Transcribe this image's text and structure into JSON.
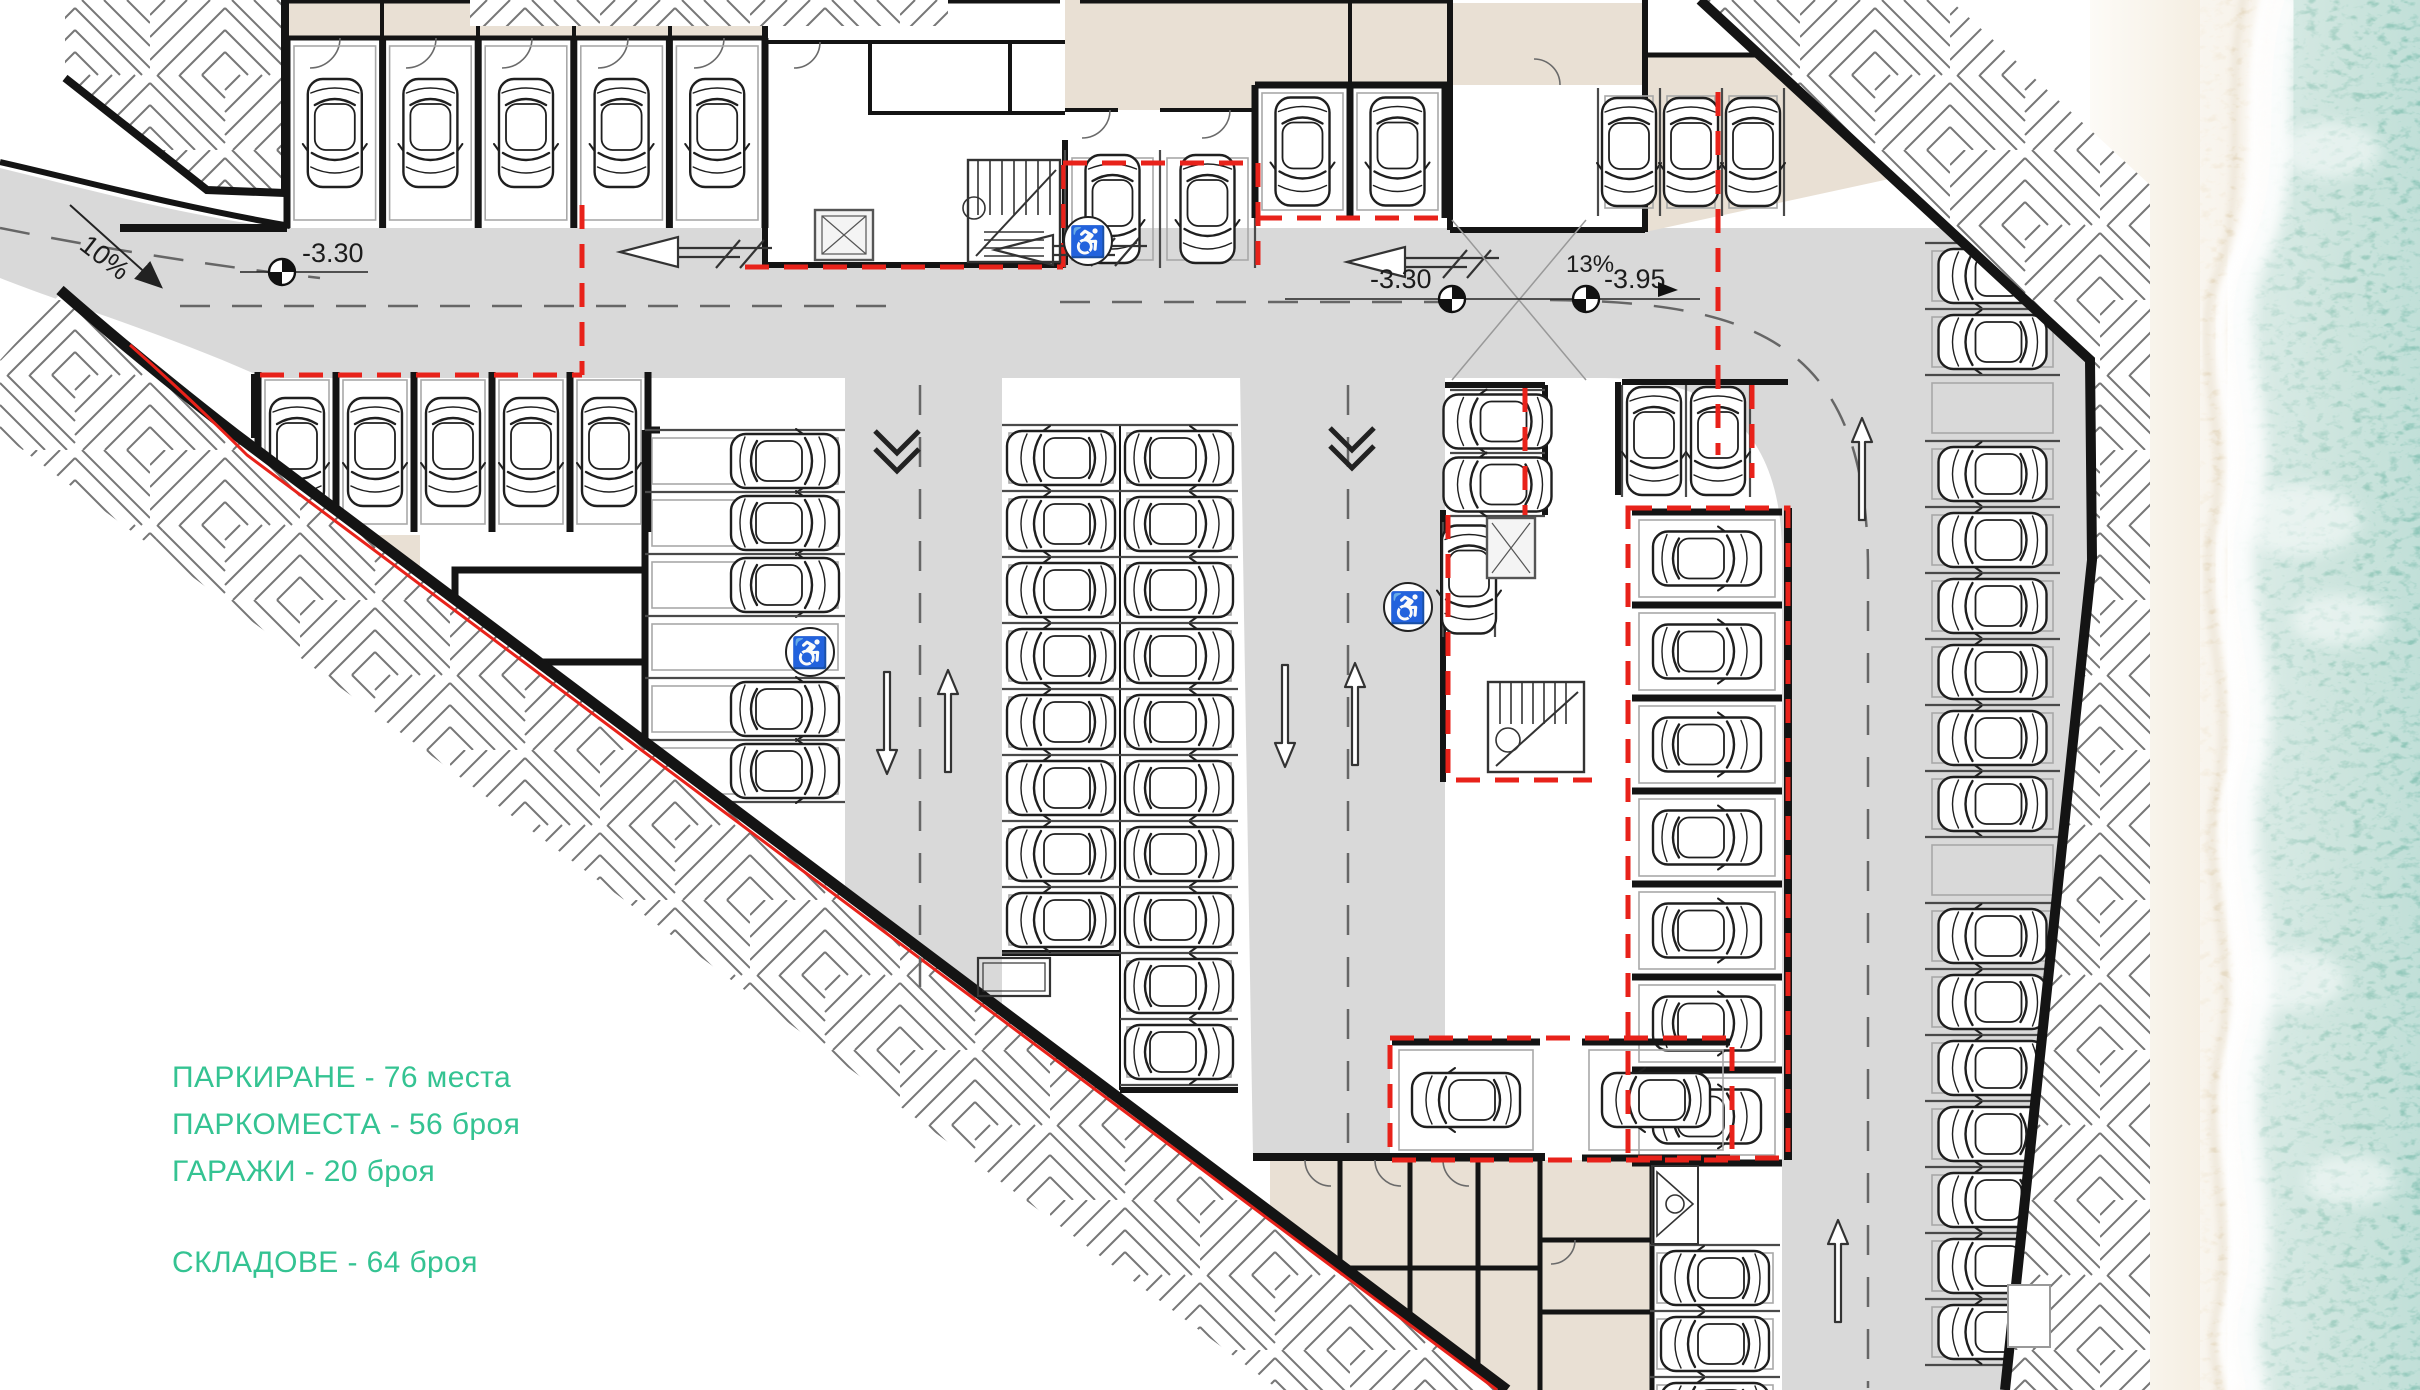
{
  "title": "Подземен паркинг - разпределение",
  "legend": {
    "color": "#34c392",
    "lines": [
      {
        "text": "ПАРКИРАНЕ - 76 места"
      },
      {
        "text": "ПАРКОМЕСТА - 56 броя"
      },
      {
        "text": "ГАРАЖИ - 20 броя"
      },
      {
        "text": "СКЛАДОВЕ - 64 броя"
      }
    ]
  },
  "annotations": {
    "ramp_left_slope": "10%",
    "level_left": "-3.30",
    "level_mid": "-3.30",
    "ramp_mid_slope": "13%",
    "level_right": "-3.95"
  },
  "colors": {
    "aisle": "#d9d9d9",
    "room_beige": "#e9e0d4",
    "wall": "#141414",
    "red_zone": "#e8221a",
    "legend_green": "#34c392",
    "water": "#8cc5b8",
    "water_light": "#c2ded6",
    "sand": "#e9ddc9",
    "sand_light": "#fdfbf7"
  },
  "symbols": {
    "accessible": "♿"
  },
  "parking_rows": [
    {
      "id": "garages-top-left",
      "dir": "v",
      "x": 287,
      "y": 38,
      "pitch": 95.6,
      "count": 5,
      "depth": 190,
      "garage": true,
      "facing": "down",
      "cars": [
        1,
        1,
        1,
        1,
        1
      ]
    },
    {
      "id": "garages-row2",
      "dir": "v",
      "x": 258,
      "y": 372,
      "pitch": 78,
      "count": 5,
      "depth": 160,
      "garage": true,
      "facing": "down",
      "cars": [
        1,
        1,
        1,
        1,
        1
      ]
    },
    {
      "id": "left-center-column",
      "dir": "h",
      "x": 645,
      "y": 430,
      "pitch": 62,
      "count": 6,
      "depth": 200,
      "garage": false,
      "facing": "right",
      "car_dx": 40,
      "cars": [
        1,
        1,
        1,
        0,
        1,
        1
      ]
    },
    {
      "id": "central-left",
      "dir": "h",
      "x": 1002,
      "y": 425,
      "pitch": 66,
      "count": 8,
      "depth": 118,
      "garage": false,
      "facing": "left",
      "cars": [
        1,
        1,
        1,
        1,
        1,
        1,
        1,
        1
      ]
    },
    {
      "id": "central-right",
      "dir": "h",
      "x": 1120,
      "y": 425,
      "pitch": 66,
      "count": 10,
      "depth": 118,
      "garage": false,
      "facing": "right",
      "cars": [
        1,
        1,
        1,
        1,
        1,
        1,
        1,
        1,
        1,
        1
      ]
    },
    {
      "id": "top-center-pair",
      "dir": "v",
      "x": 1065,
      "y": 150,
      "pitch": 95,
      "count": 2,
      "depth": 118,
      "garage": false,
      "facing": "down",
      "cars": [
        1,
        1
      ]
    },
    {
      "id": "top-center-garages",
      "dir": "v",
      "x": 1255,
      "y": 85,
      "pitch": 95,
      "count": 2,
      "depth": 133,
      "garage": true,
      "facing": "down",
      "cars": [
        1,
        1
      ]
    },
    {
      "id": "top-right-stalls",
      "dir": "v",
      "x": 1598,
      "y": 88,
      "pitch": 62,
      "count": 3,
      "depth": 128,
      "garage": false,
      "facing": "down",
      "cars": [
        1,
        1,
        1
      ]
    },
    {
      "id": "mid-right-pair",
      "dir": "h",
      "x": 1450,
      "y": 390,
      "pitch": 63,
      "count": 2,
      "depth": 95,
      "garage": false,
      "facing": "left",
      "cars": [
        1,
        1
      ]
    },
    {
      "id": "mid-right-single",
      "dir": "v",
      "x": 1443,
      "y": 522,
      "pitch": 52,
      "count": 1,
      "depth": 115,
      "garage": false,
      "marking": false,
      "facing": "down",
      "cars": [
        1
      ]
    },
    {
      "id": "mid-right-top-pair",
      "dir": "v",
      "x": 1622,
      "y": 385,
      "pitch": 64,
      "count": 2,
      "depth": 112,
      "garage": false,
      "facing": "down",
      "cars": [
        1,
        1
      ]
    },
    {
      "id": "garage-column-right",
      "dir": "h",
      "x": 1632,
      "y": 512,
      "pitch": 93,
      "count": 7,
      "depth": 150,
      "garage": true,
      "facing": "right",
      "cars": [
        1,
        1,
        1,
        1,
        1,
        1,
        1
      ]
    },
    {
      "id": "bottom-garage-a",
      "dir": "h",
      "x": 1392,
      "y": 1042,
      "pitch": 116,
      "count": 1,
      "depth": 148,
      "garage": true,
      "facing": "left",
      "cars": [
        1
      ]
    },
    {
      "id": "bottom-garage-b",
      "dir": "h",
      "x": 1582,
      "y": 1042,
      "pitch": 116,
      "count": 1,
      "depth": 148,
      "garage": true,
      "facing": "left",
      "cars": [
        1
      ]
    },
    {
      "id": "right-long-column",
      "dir": "h",
      "x": 1925,
      "y": 243,
      "pitch": 66,
      "count": 17,
      "depth": 135,
      "garage": false,
      "facing": "left",
      "cars": [
        1,
        1,
        0,
        1,
        1,
        1,
        1,
        1,
        1,
        0,
        1,
        1,
        1,
        1,
        1,
        1,
        1
      ]
    },
    {
      "id": "bottom-column",
      "dir": "h",
      "x": 1650,
      "y": 1245,
      "pitch": 66,
      "count": 3,
      "depth": 130,
      "garage": false,
      "facing": "left",
      "cars": [
        1,
        1,
        1
      ]
    }
  ]
}
